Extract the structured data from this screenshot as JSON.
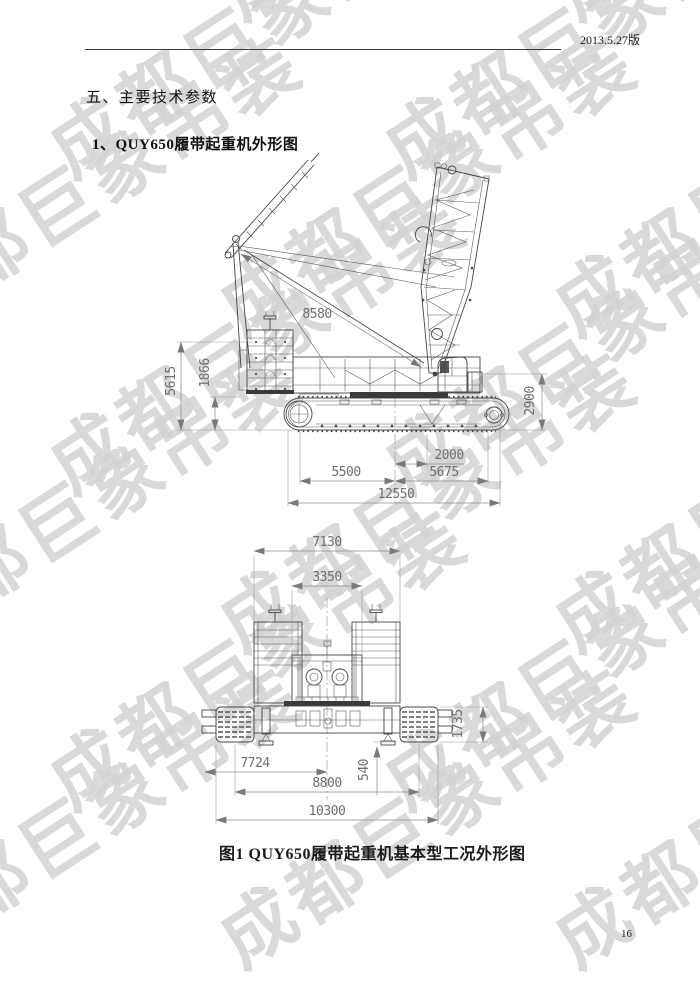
{
  "page": {
    "version_label": "2013.5.27版",
    "page_number": "16"
  },
  "watermark": {
    "text": "成都巨象吊装",
    "color": "#d3d3d3"
  },
  "headings": {
    "section": "五、主要技术参数",
    "subsection": "1、QUY650履带起重机外形图",
    "figure_caption": "图1 QUY650履带起重机基本型工况外形图"
  },
  "side_view": {
    "dims": {
      "pendant_diag": "8580",
      "left_outer_v": "5615",
      "left_inner_v": "1866",
      "right_v": "2900",
      "small_h": "2000",
      "bottom_left_h": "5500",
      "bottom_right_h": "5675",
      "overall_h": "12550"
    }
  },
  "rear_view": {
    "dims": {
      "top_outer": "7130",
      "top_inner": "3350",
      "right_side_v": "1735",
      "center_small_v": "540",
      "bottom_first": "7724",
      "bottom_second": "8800",
      "bottom_overall": "10300"
    }
  }
}
